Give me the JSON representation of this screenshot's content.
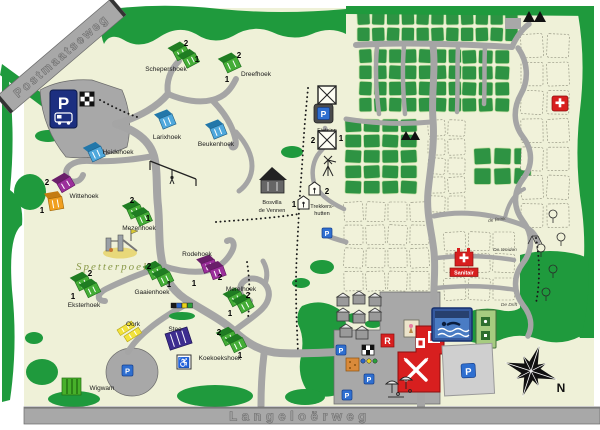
{
  "map": {
    "roads": {
      "top": "Postmaatseweg",
      "bottom": "Langeloërweg"
    },
    "compass": "N",
    "glyphs": {
      "p": "P",
      "r": "R",
      "wheelchair": "♿"
    },
    "num1": "1",
    "num2": "2",
    "labels": {
      "spetterpoel": "Spetterpoel",
      "bosvilla1": "Bosvilla",
      "bosvilla2": "de Vennen",
      "trek1": "Trekkers-",
      "trek2": "hutten",
      "fietsinn": "Fietsinn",
      "sanitair": "Sanitair",
      "brink": "de Brink",
      "weiden": "De Weiden",
      "drift": "De Drift"
    },
    "areas": {
      "schepershoek": "Schepershoek",
      "dreefhoek": "Dreefhoek",
      "larixhoek": "Larixhoek",
      "beukenhoek": "Beukenhoek",
      "heidehoek": "Heidehoek",
      "wittehoek": "Wittehoek",
      "mezenhoek": "Mezenhoek",
      "rodehoek": "Rodehoek",
      "gaaienhoek": "Gaaienhoek",
      "eksterhoek": "Eksterhoek",
      "merelhoek": "Merelhoek",
      "koekoekshoek": "Koekoekshoek",
      "oork": "Oork",
      "stee": "Stee",
      "wigwam": "Wigwam"
    },
    "colors": {
      "forest": "#1f9a3d",
      "pitch_green": "#2e9343",
      "cream": "#eff1d8",
      "road": "#a5a5a5",
      "red": "#d81f1f",
      "navy": "#1c2f80",
      "parking_blue": "#2f6fd0"
    }
  }
}
